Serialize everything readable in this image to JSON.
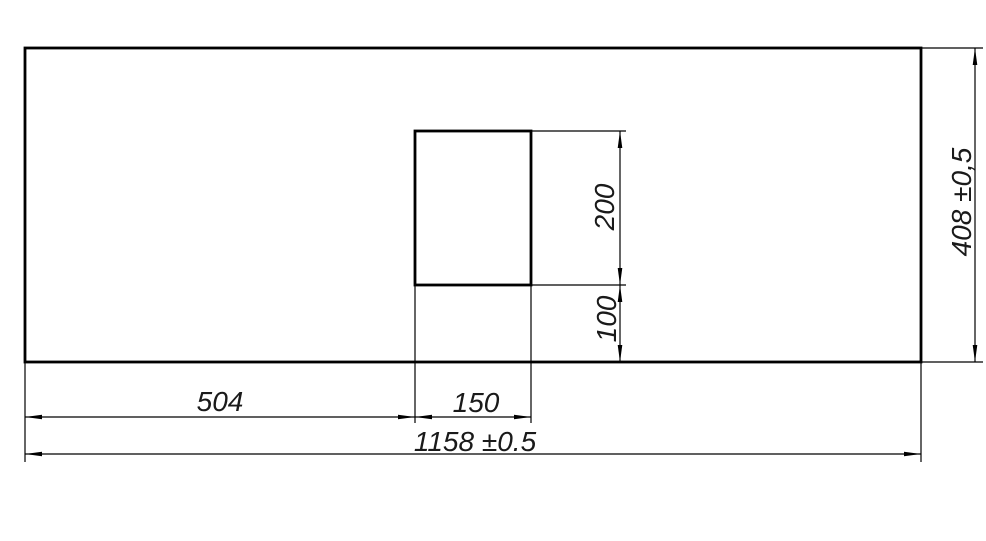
{
  "drawing": {
    "type": "technical-dimension-drawing",
    "colors": {
      "background": "#ffffff",
      "line": "#000000",
      "text": "#1a1a1a"
    },
    "labels": {
      "cutout_offset_x": "504",
      "cutout_width": "150",
      "total_width": "1158 ±0.5",
      "cutout_height": "200",
      "cutout_bottom_offset": "100",
      "total_height": "408 ±0,5"
    }
  }
}
